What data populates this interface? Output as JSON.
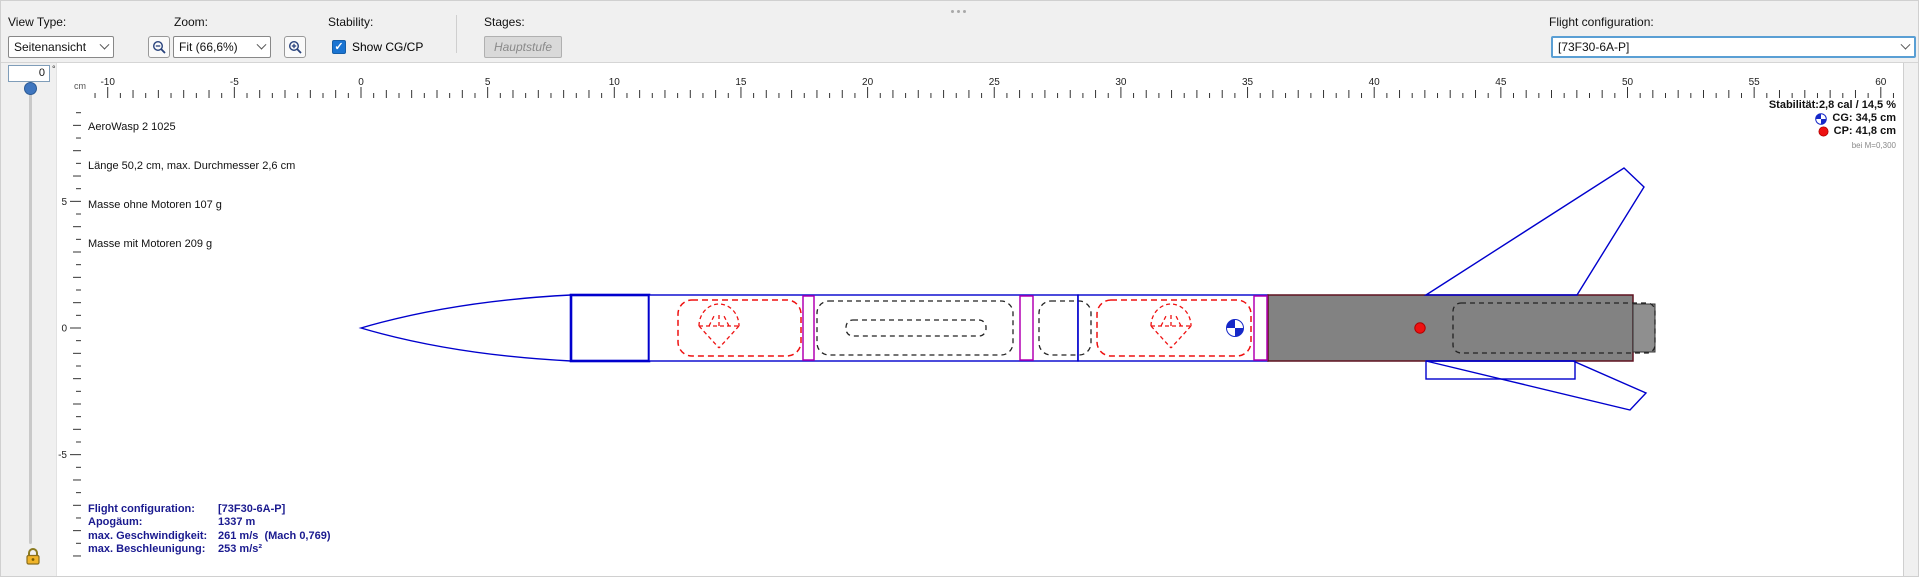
{
  "toolbar": {
    "view_type_label": "View Type:",
    "view_type_value": "Seitenansicht",
    "zoom_label": "Zoom:",
    "zoom_value": "Fit (66,6%)",
    "stability_label": "Stability:",
    "show_cg_cp_label": "Show CG/CP",
    "stages_label": "Stages:",
    "stage_button_label": "Hauptstufe",
    "flight_config_label": "Flight configuration:",
    "flight_config_value": "[73F30-6A-P]"
  },
  "rotation": {
    "value": "0",
    "unit": "°"
  },
  "rocket_info": {
    "name": "AeroWasp 2 1025",
    "dimensions": "Länge 50,2 cm, max. Durchmesser 2,6 cm",
    "mass_without_motors": "Masse ohne Motoren 107 g",
    "mass_with_motors": "Masse mit Motoren 209 g"
  },
  "stability_info": {
    "stability": "Stabilität:2,8 cal / 14,5 %",
    "cg": "CG: 34,5 cm",
    "cp": "CP: 41,8 cm",
    "mach_note": "bei M=0,300"
  },
  "flight_data": {
    "rows": [
      {
        "label": "Flight configuration:",
        "value": "[73F30-6A-P]"
      },
      {
        "label": "Apogäum:",
        "value": "1337 m"
      },
      {
        "label": "max. Geschwindigkeit:",
        "value": "261 m/s  (Mach 0,769)"
      },
      {
        "label": "max. Beschleunigung:",
        "value": "253 m/s²"
      }
    ]
  },
  "ruler": {
    "unit": "cm",
    "h_min": -10.5,
    "h_max": 60.5,
    "v_min": -9,
    "v_max": 8.5,
    "label_step": 5
  },
  "colors": {
    "accent_blue": "#0000cd",
    "magenta": "#b300b3",
    "red": "#ee1111",
    "motor_gray": "#828282",
    "navy_text": "#1a1a8f",
    "toolbar_bg": "#f0f0f0",
    "focus_blue": "#5a9fd4"
  }
}
